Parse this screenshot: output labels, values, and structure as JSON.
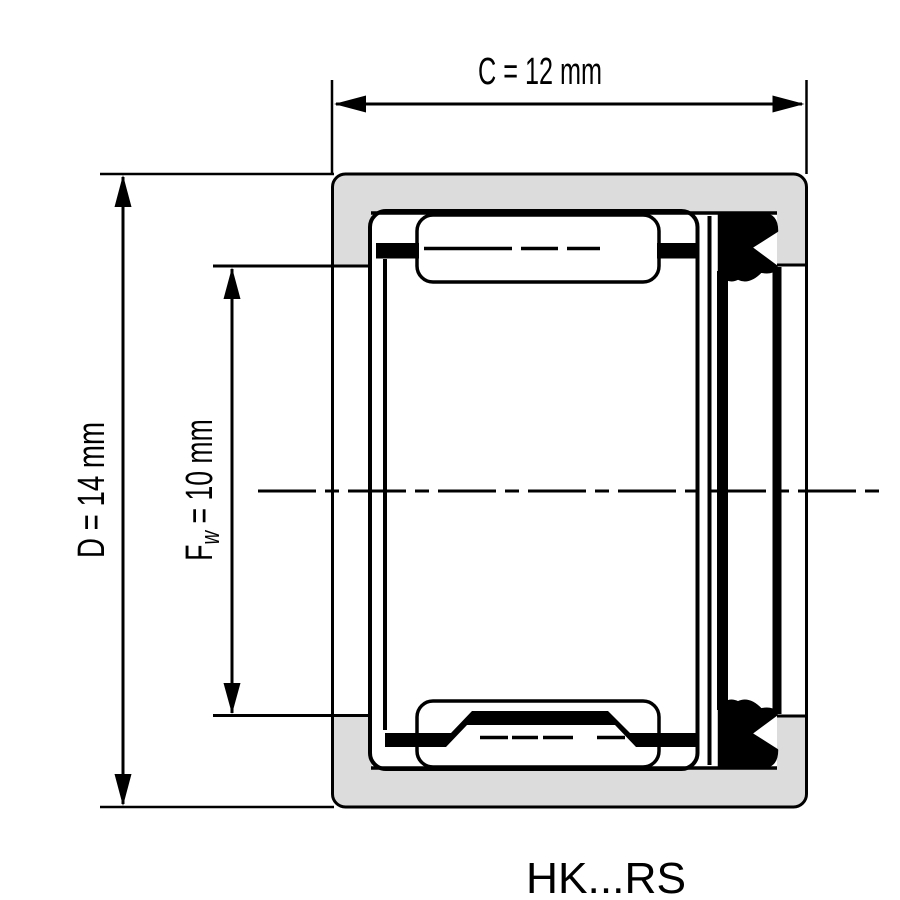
{
  "part_label": "HK...RS",
  "dims": {
    "c": {
      "label": "C = 12 mm",
      "symbol": "C",
      "value": "12",
      "unit": "mm",
      "orientation": "horizontal"
    },
    "d": {
      "label": "D = 14 mm",
      "symbol": "D",
      "value": "14",
      "unit": "mm",
      "orientation": "vertical"
    },
    "fw": {
      "base": "F",
      "sub": "w",
      "rest": " = 10 mm",
      "symbol": "Fw",
      "value": "10",
      "unit": "mm",
      "orientation": "vertical"
    }
  },
  "colors": {
    "line": "#000000",
    "shell_fill": "#dcdcdc",
    "background": "#ffffff"
  }
}
